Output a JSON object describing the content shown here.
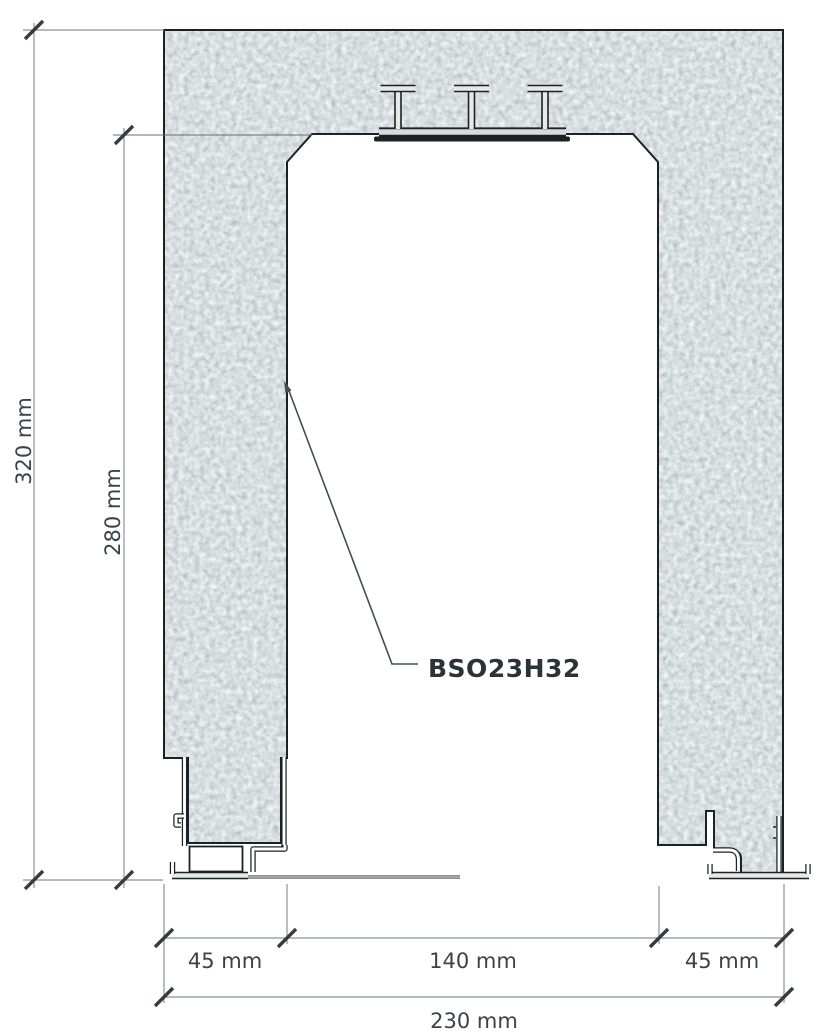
{
  "diagram": {
    "product_label": "BSO23H32",
    "dimensions": {
      "overall_height": "320 mm",
      "opening_height": "280 mm",
      "left_frame_width": "45 mm",
      "clear_opening_width": "140 mm",
      "right_frame_width": "45 mm",
      "overall_width": "230 mm"
    },
    "colors": {
      "concrete_mid": "#6f7b81",
      "concrete_dark": "#455258",
      "concrete_light": "#aab3b5",
      "outline": "#1b2225",
      "dimension_line": "#8b9397",
      "tick_mark": "#343c40",
      "label_text": "#39434a"
    }
  }
}
